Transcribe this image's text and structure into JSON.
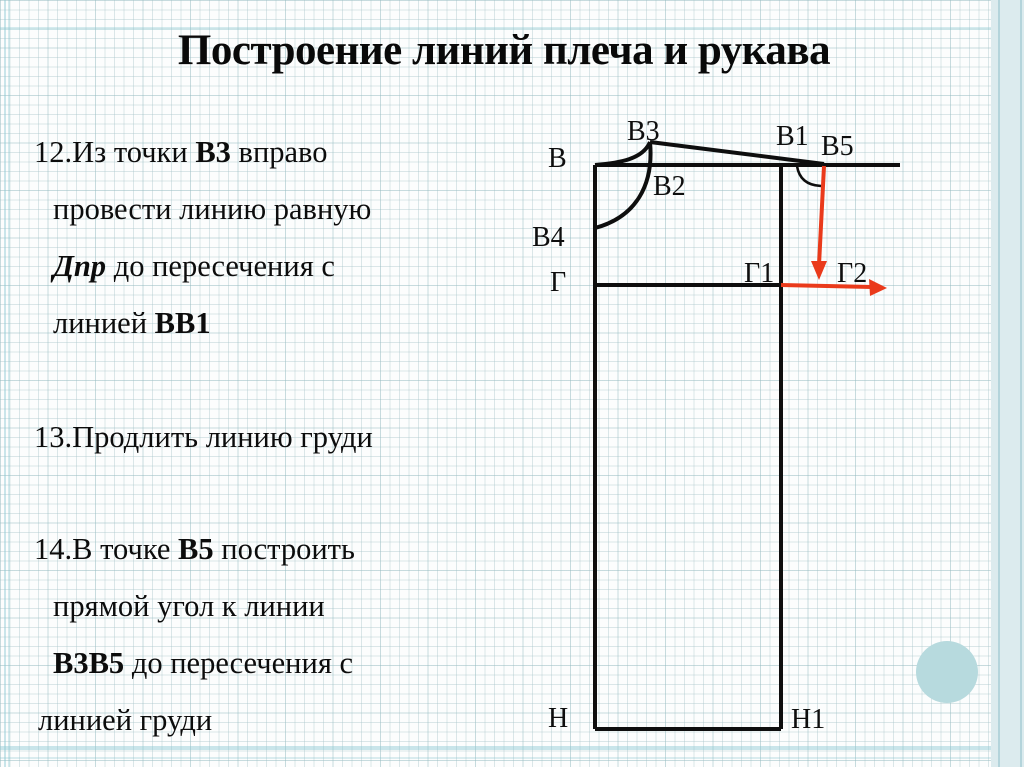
{
  "title": "Построение линий плеча и рукава",
  "instructions": {
    "item12": {
      "l1a": "12.Из точки ",
      "l1b": "В3",
      "l1c": " вправо",
      "l2": "провести линию равную",
      "l3a": "Дпр",
      "l3b": " до пересечения с",
      "l4a": "линией ",
      "l4b": "ВВ1"
    },
    "item13": {
      "l1": "13.Продлить линию груди"
    },
    "item14": {
      "l1a": "14.В точке ",
      "l1b": "В5",
      "l1c": " построить",
      "l2": "прямой угол к линии",
      "l3a": "В3В5",
      "l3b": " до пересечения с",
      "l4": "линией груди"
    }
  },
  "diagram": {
    "labels": {
      "b": "В",
      "b3": "В3",
      "b2": "В2",
      "b1": "В1",
      "b5": "В5",
      "b4": "В4",
      "g": "Г",
      "g1": "Г1",
      "g2": "Г2",
      "n": "Н",
      "n1": "Н1"
    },
    "colors": {
      "pattern_line": "#0e0e0e",
      "construction_line": "#ea3a1b"
    }
  },
  "decor": {
    "accent_circle_color": "#b7dade",
    "right_margin_strip_color": "#dcebee"
  }
}
